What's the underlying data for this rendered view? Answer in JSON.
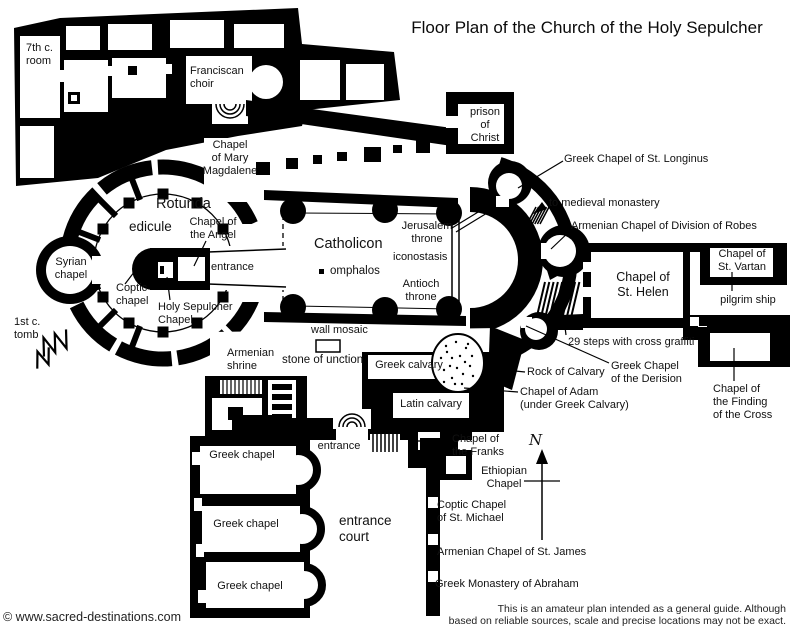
{
  "title": "Floor Plan of the Church of the Holy Sepulcher",
  "compass": "N",
  "copyright": "© www.sacred-destinations.com",
  "disclaimer": "This is an amateur plan intended as a general guide. Although\nbased on reliable sources, scale and precise locations may not be exact.",
  "colors": {
    "wall": "#000000",
    "background": "#ffffff",
    "text": "#111111"
  },
  "labels": {
    "seventh_c_room": "7th c.\nroom",
    "franciscan_choir": "Franciscan\nchoir",
    "chapel_mary_magdalene": "Chapel\nof Mary\nMagdalene",
    "prison_of_christ": "prison\nof\nChrist",
    "greek_chapel_st_longinus": "Greek Chapel of St. Longinus",
    "rotunda": "Rotunda",
    "edicule": "edicule",
    "chapel_of_the_angel": "Chapel of\nthe Angel",
    "to_medieval_monastery": "to medieval monastery",
    "armenian_chapel_division_robes": "Armenian Chapel of Division of Robes",
    "syrian_chapel": "Syrian\nchapel",
    "coptic_chapel": "Coptic\nchapel",
    "edicule_entrance": "entrance",
    "holy_sepulcher_chapel": "Holy Sepulcher\nChapel",
    "first_century_tomb": "1st c.\ntomb",
    "catholicon": "Catholicon",
    "omphalos": "omphalos",
    "jerusalem_throne": "Jerusalem\nthrone",
    "iconostasis": "iconostasis",
    "antioch_throne": "Antioch\nthrone",
    "chapel_st_helen": "Chapel of\nSt. Helen",
    "chapel_st_vartan": "Chapel of\nSt. Vartan",
    "pilgrim_ship": "pilgrim ship",
    "steps_29": "29 steps with cross graffiti",
    "wall_mosaic": "wall mosaic",
    "armenian_shrine": "Armenian\nshrine",
    "stone_of_unction": "stone of unction",
    "greek_calvary": "Greek calvary",
    "rock_of_calvary": "Rock of Calvary",
    "greek_chapel_derision": "Greek Chapel\nof the Derision",
    "chapel_of_adam": "Chapel of Adam\n(under Greek Calvary)",
    "latin_calvary": "Latin calvary",
    "chapel_finding_cross": "Chapel of\nthe Finding\nof the Cross",
    "south_entrance": "entrance",
    "chapel_of_the_franks": "Chapel of\nthe Franks",
    "greek_chapel_1": "Greek chapel",
    "greek_chapel_2": "Greek chapel",
    "greek_chapel_3": "Greek chapel",
    "entrance_court": "entrance\ncourt",
    "ethiopian_chapel": "Ethiopian\nChapel",
    "coptic_chapel_st_michael": "Coptic Chapel\nof St. Michael",
    "armenian_chapel_st_james": "Armenian Chapel of St. James",
    "greek_monastery_abraham": "Greek Monastery of Abraham"
  }
}
